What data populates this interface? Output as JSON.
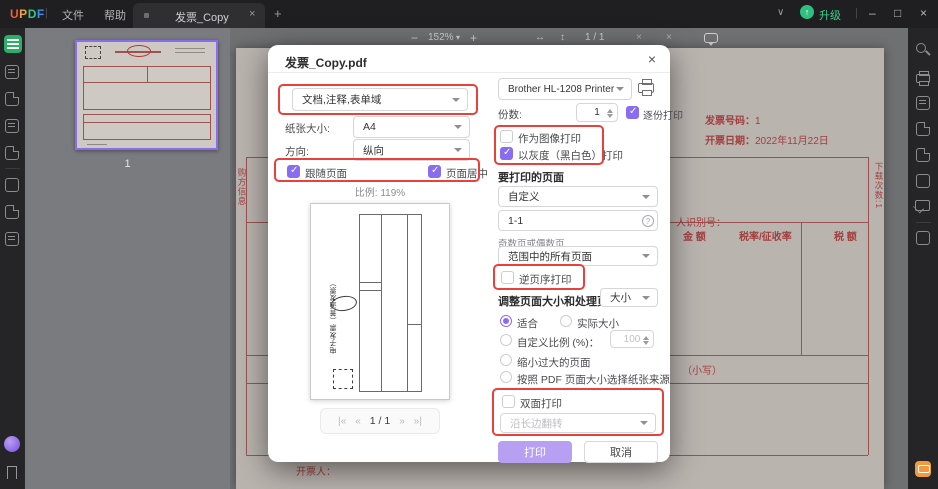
{
  "colors": {
    "accent_purple": "#8A6CF0",
    "print_button_purple": "#B79FF2",
    "annotation_red": "#E8413C",
    "active_tool_green": "#2BAE66",
    "upgrade_green": "#3ECF8E",
    "invoice_red": "#A33E3E"
  },
  "titlebar": {
    "logo_letters": [
      "U",
      "P",
      "D",
      "F"
    ],
    "logo_colors": [
      "#F25C3C",
      "#F2A53C",
      "#35C48B",
      "#3C8CF2"
    ],
    "menu_file": "文件",
    "menu_help": "帮助",
    "tab_title": "发票_Copy",
    "upgrade_label": "升级",
    "icons": {
      "chevron_down": "∨",
      "minimize": "–",
      "restore": "□",
      "close": "×",
      "plus": "+",
      "tab_close": "×",
      "upgrade_arrow": "↑"
    }
  },
  "doc_toolbar": {
    "zoom_out": "−",
    "zoom_level": "152%",
    "zoom_caret": "▾",
    "zoom_in": "+",
    "fit_width": "↔",
    "fit_page": "↕",
    "page_indicator": "1 / 1",
    "misc_left": "×",
    "misc_right": "×"
  },
  "thumbnail_panel": {
    "page_number": "1"
  },
  "dialog": {
    "title": "发票_Copy.pdf",
    "close": "×",
    "content_select": "文档,注释,表单域",
    "paper_size_label": "纸张大小:",
    "paper_size_value": "A4",
    "orientation_label": "方向:",
    "orientation_value": "纵向",
    "cb_follow_page": "跟随页面",
    "cb_center_page": "页面居中",
    "scale_text": "比例: 119%",
    "pager": {
      "first": "|«",
      "prev": "«",
      "current": "1 / 1",
      "next": "»",
      "last": "»|"
    },
    "printer_name": "Brother HL-1208 Printer",
    "copies_label": "份数:",
    "copies_value": "1",
    "cb_collate": "逐份打印",
    "cb_print_as_image": "作为图像打印",
    "cb_grayscale": "以灰度（黑白色）打印",
    "pages_section": "要打印的页面",
    "pages_mode": "自定义",
    "pages_range": "1-1",
    "range_hint": "?",
    "odd_even_label": "奇数页或偶数页",
    "odd_even_value": "范围中的所有页面",
    "cb_reverse": "逆页序打印",
    "sizing_section": "调整页面大小和处理页面",
    "sizing_dropdown": "大小",
    "radio_fit": "适合",
    "radio_actual": "实际大小",
    "radio_custom_scale": "自定义比例 (%)：",
    "custom_scale_value": "100",
    "radio_shrink": "缩小过大的页面",
    "radio_paper_source": "按照 PDF 页面大小选择纸张来源",
    "cb_duplex": "双面打印",
    "duplex_mode": "沿长边翻转",
    "print_button": "打印",
    "cancel_button": "取消",
    "state": {
      "follow_page": true,
      "center_page": true,
      "collate": true,
      "print_as_image": false,
      "grayscale": true,
      "reverse": false,
      "duplex": false,
      "fit": true,
      "actual": false,
      "custom_scale": false,
      "shrink": false,
      "paper_source": false
    }
  },
  "preview": {
    "vertical_title": "电子发票（普通发票）"
  },
  "invoice": {
    "number_label": "发票号码：",
    "number_value": "1",
    "date_label": "开票日期：",
    "date_value": "2022年11月22日",
    "buyer_id_label": "人识别号：",
    "col_amount": "金  额",
    "col_rate": "税率/征收率",
    "col_tax": "税  额",
    "small_amount": "（小写）",
    "issuer_label": "开票人：",
    "download_count": "下载次数:1",
    "buyer_side_label": "购方信息"
  }
}
